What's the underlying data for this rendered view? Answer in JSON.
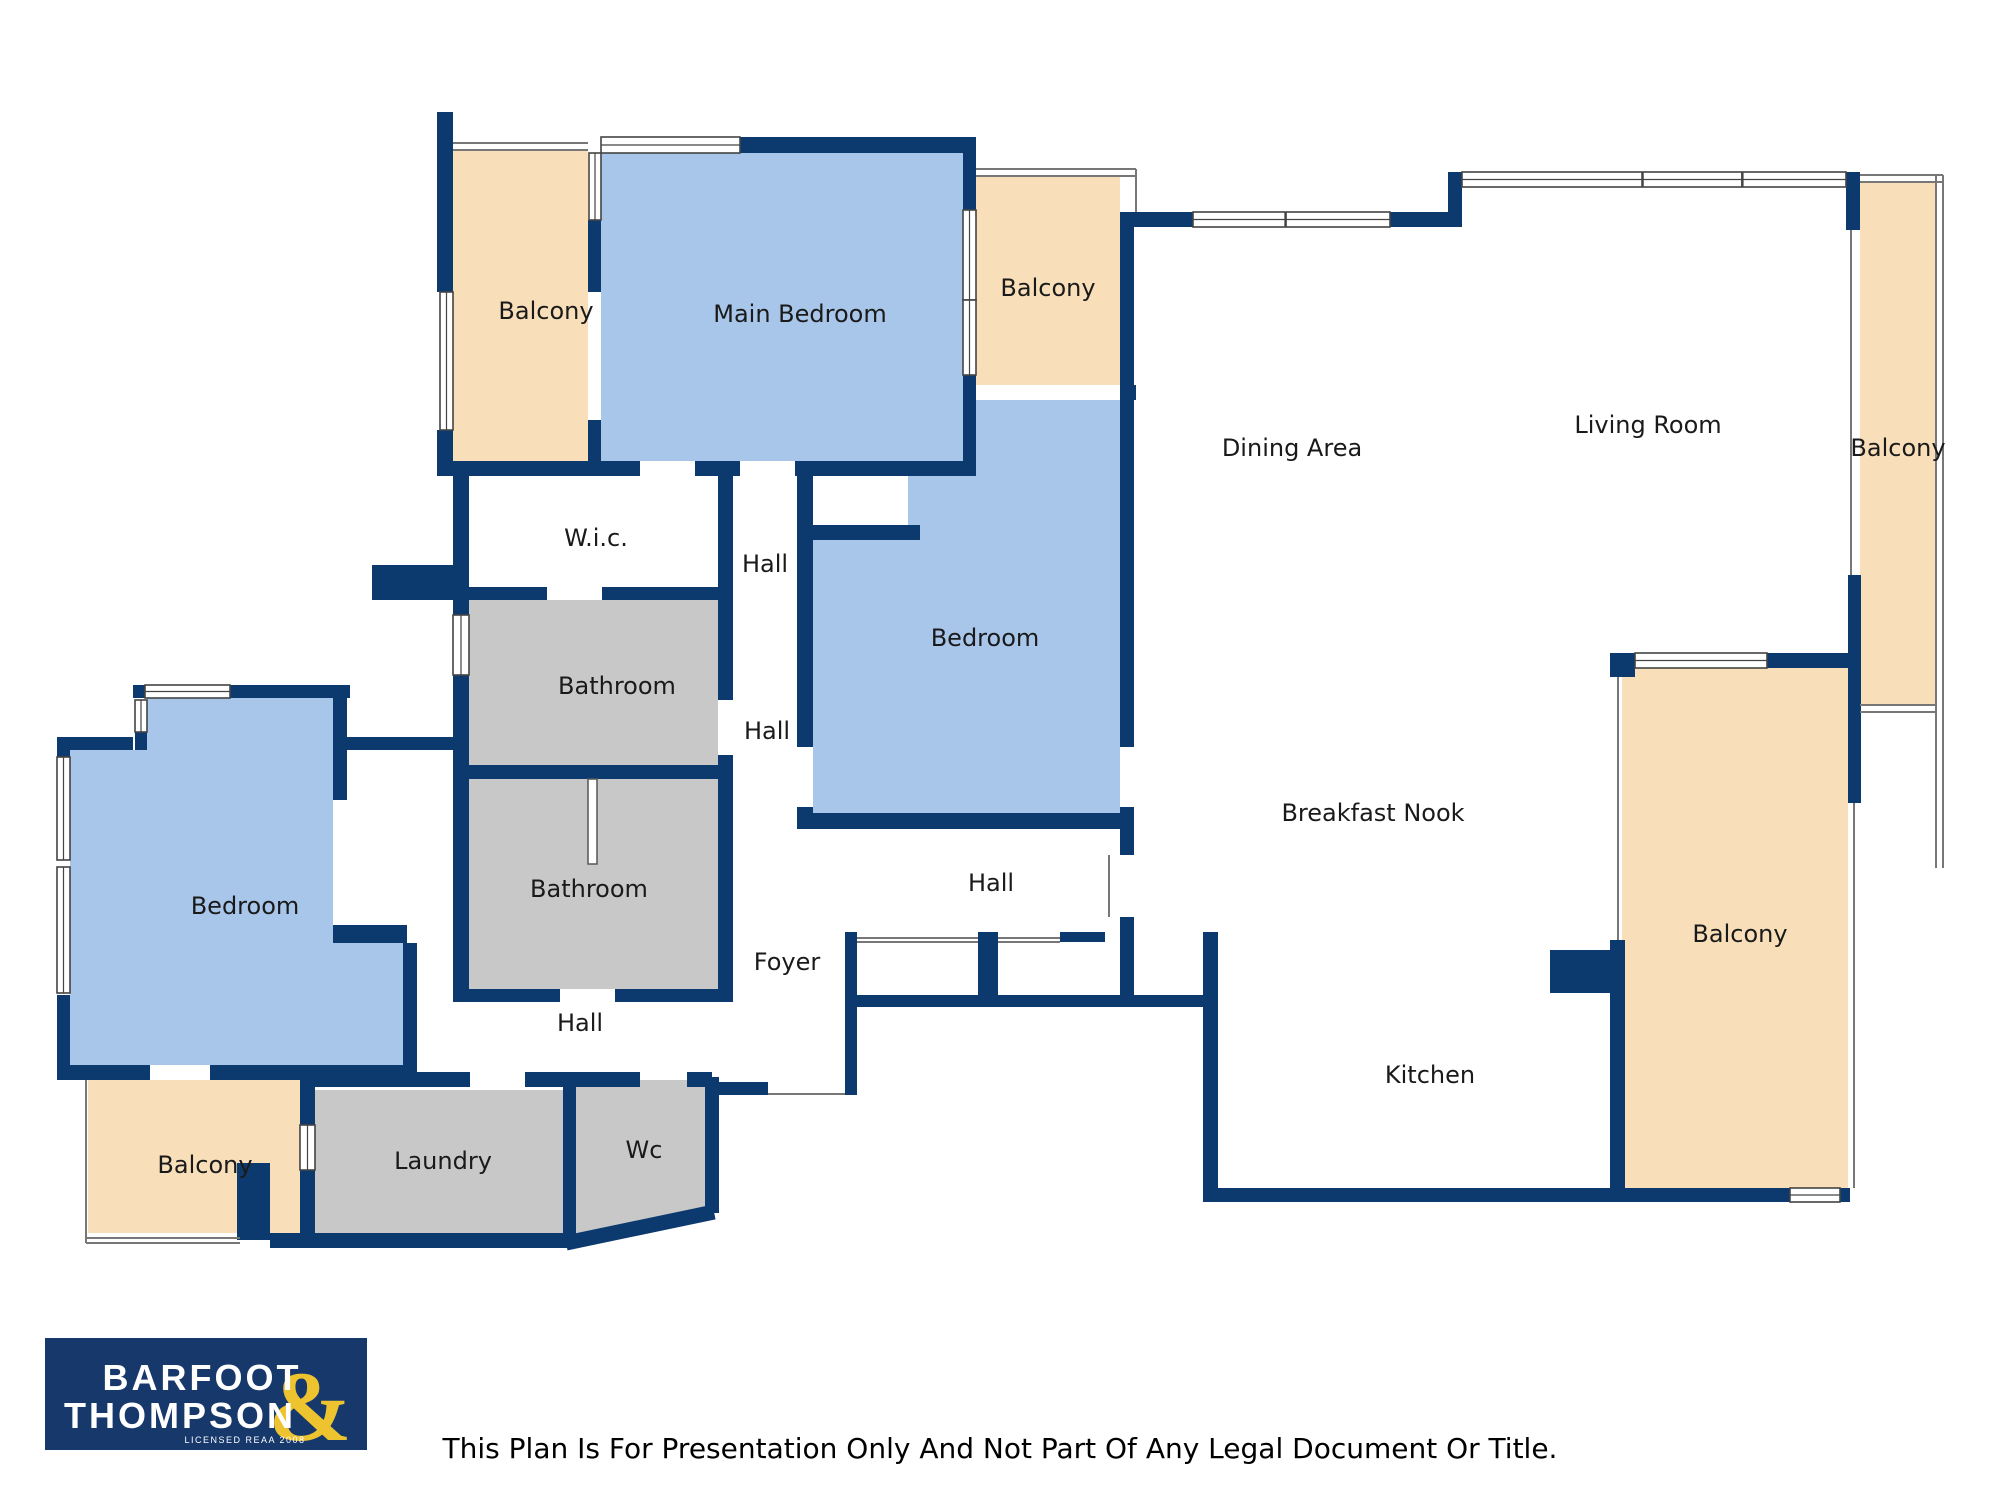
{
  "colors": {
    "wall_navy": "#0d3a6e",
    "room_blue": "#a8c6ea",
    "room_peach": "#f8dfba",
    "room_gray": "#c8c8c8",
    "room_white": "#ffffff",
    "logo_background": "#16386b",
    "logo_gold": "#edc32f",
    "label_text": "#1a1a1a"
  },
  "rooms": [
    {
      "id": "balcony-top-left",
      "label": "Balcony"
    },
    {
      "id": "main-bedroom",
      "label": "Main Bedroom"
    },
    {
      "id": "balcony-top",
      "label": "Balcony"
    },
    {
      "id": "dining-area",
      "label": "Dining Area"
    },
    {
      "id": "living-room",
      "label": "Living Room"
    },
    {
      "id": "balcony-right",
      "label": "Balcony"
    },
    {
      "id": "wic",
      "label": "W.i.c."
    },
    {
      "id": "hall-upper",
      "label": "Hall"
    },
    {
      "id": "bedroom-middle",
      "label": "Bedroom"
    },
    {
      "id": "bathroom-upper",
      "label": "Bathroom"
    },
    {
      "id": "hall-middle",
      "label": "Hall"
    },
    {
      "id": "breakfast-nook",
      "label": "Breakfast Nook"
    },
    {
      "id": "bedroom-left",
      "label": "Bedroom"
    },
    {
      "id": "bathroom-lower",
      "label": "Bathroom"
    },
    {
      "id": "hall-center",
      "label": "Hall"
    },
    {
      "id": "foyer",
      "label": "Foyer"
    },
    {
      "id": "hall-lower",
      "label": "Hall"
    },
    {
      "id": "balcony-bottom-left",
      "label": "Balcony"
    },
    {
      "id": "laundry",
      "label": "Laundry"
    },
    {
      "id": "wc",
      "label": "Wc"
    },
    {
      "id": "kitchen",
      "label": "Kitchen"
    },
    {
      "id": "balcony-bottom-right",
      "label": "Balcony"
    }
  ],
  "branding": {
    "line1": "BARFOOT",
    "line2": "THOMPSON",
    "ampersand": "&",
    "tagline": "LICENSED REAA 2008"
  },
  "disclaimer": "This Plan Is For Presentation Only And Not Part Of Any Legal Document Or Title."
}
